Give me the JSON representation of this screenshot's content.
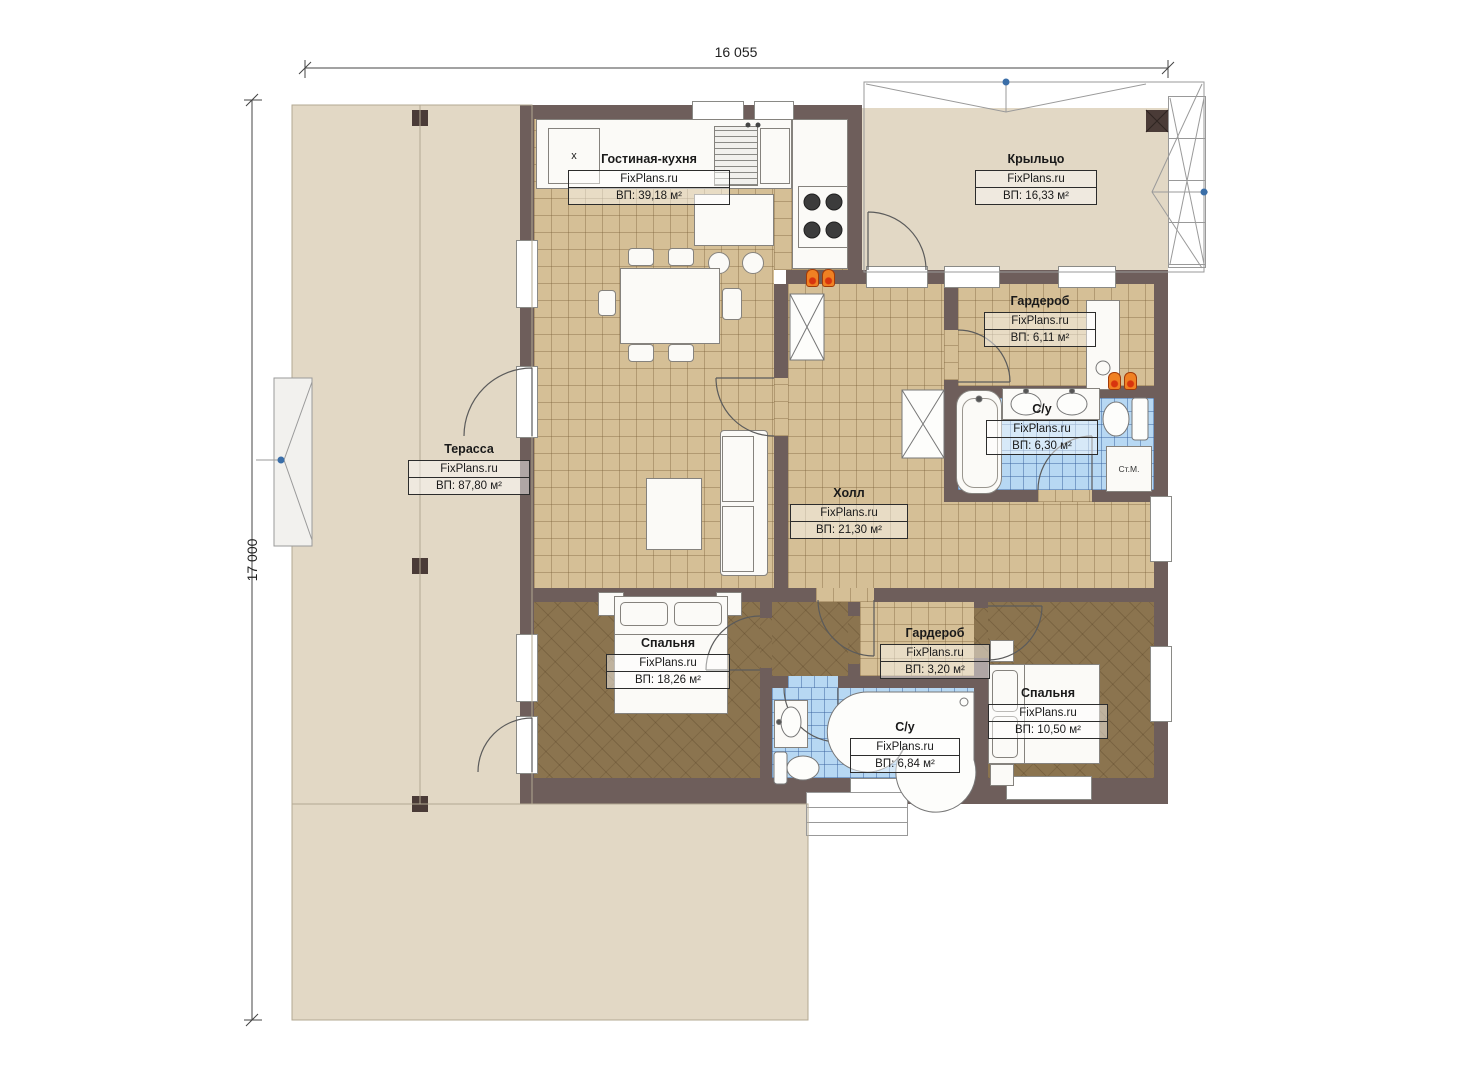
{
  "brand": "FixPlans.ru",
  "dimensions": {
    "width": "16 055",
    "height": "17 000"
  },
  "rooms": {
    "living_kitchen": {
      "name": "Гостиная-кухня",
      "area": "ВП: 39,18 м²"
    },
    "porch": {
      "name": "Крыльцо",
      "area": "ВП: 16,33 м²"
    },
    "terrace": {
      "name": "Терасса",
      "area": "ВП: 87,80 м²"
    },
    "hall": {
      "name": "Холл",
      "area": "ВП: 21,30 м²"
    },
    "wardrobe_top": {
      "name": "Гардероб",
      "area": "ВП: 6,11 м²"
    },
    "bathroom_top": {
      "name": "С/у",
      "area": "ВП: 6,30 м²"
    },
    "bedroom_left": {
      "name": "Спальня",
      "area": "ВП: 18,26 м²"
    },
    "wardrobe_bottom": {
      "name": "Гардероб",
      "area": "ВП: 3,20 м²"
    },
    "bathroom_bottom": {
      "name": "С/у",
      "area": "ВП: 6,84 м²"
    },
    "bedroom_right": {
      "name": "Спальня",
      "area": "ВП: 10,50 м²"
    }
  },
  "symbols": {
    "washing_machine": "Ст.М.",
    "dishwasher": "x"
  },
  "colors": {
    "wall": "#6e5e5b",
    "floor_tile_tan": "#d5bf96",
    "floor_wood": "#8b744f",
    "floor_tile_blue": "#b7d8f3",
    "terrace_floor": "#e2d8c5",
    "radiator_orange": "#f08123",
    "node_blue": "#3a6ea8"
  }
}
